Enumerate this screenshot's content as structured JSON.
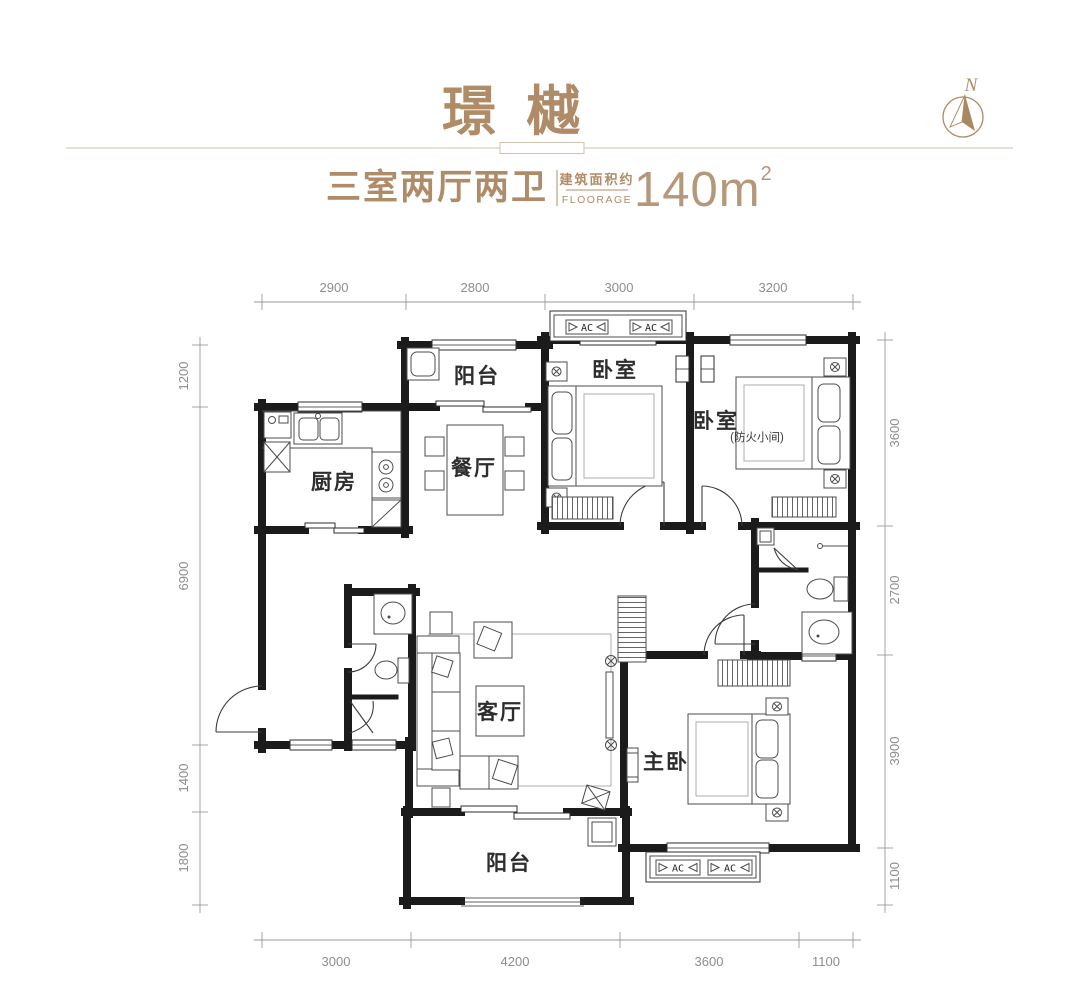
{
  "header": {
    "title": "璟樾",
    "layout_type": "三室两厅两卫",
    "area_label_cn": "建筑面积约",
    "area_label_en": "FLOORAGE",
    "area_value": "140",
    "area_unit": "m",
    "area_superscript": "2",
    "compass_letter": "N"
  },
  "colors": {
    "accent": "#b08b67",
    "area_number": "#b5977a",
    "wall": "#1b1b1b",
    "dimension_text": "#8d8d8d"
  },
  "rooms": {
    "balcony_top": "阳台",
    "kitchen": "厨房",
    "dining": "餐厅",
    "bedroom1": "卧室",
    "bedroom2": "卧室",
    "bedroom2_note": "(防火小间)",
    "living": "客厅",
    "master_bedroom": "主卧",
    "balcony_bottom": "阳台"
  },
  "plan": {
    "ac_label": "AC"
  },
  "dimensions": {
    "top": [
      "2900",
      "2800",
      "3000",
      "3200"
    ],
    "bottom": [
      "3000",
      "4200",
      "3600",
      "1100"
    ],
    "left": [
      "1200",
      "6900",
      "1400",
      "1800"
    ],
    "right": [
      "3600",
      "2700",
      "3900",
      "1100"
    ]
  }
}
